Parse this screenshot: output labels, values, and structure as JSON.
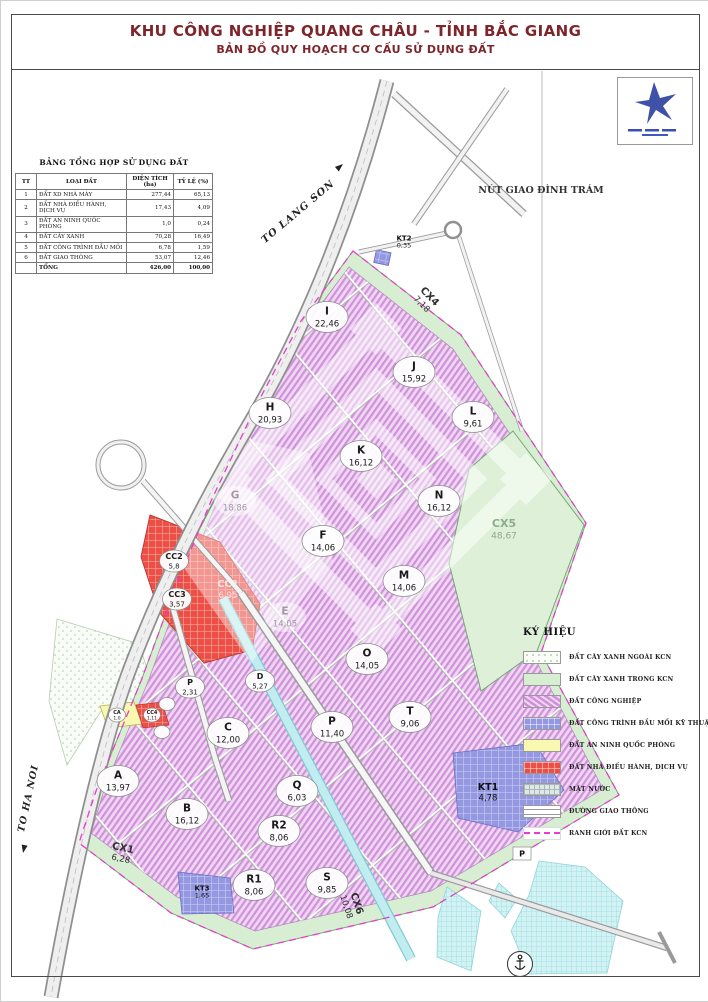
{
  "title": {
    "line1": "KHU CÔNG NGHIỆP QUANG CHÂU - TỈNH BẮC GIANG",
    "line2": "BẢN ĐỒ QUY HOẠCH CƠ CẤU SỬ DỤNG ĐẤT"
  },
  "summary_table": {
    "title": "BẢNG TỔNG HỢP SỬ DỤNG ĐẤT",
    "columns": [
      "TT",
      "LOẠI ĐẤT",
      "DIỆN TÍCH (ha)",
      "TỶ LỆ (%)"
    ],
    "rows": [
      [
        "1",
        "ĐẤT XD NHÀ MÁY",
        "277,44",
        "65,13"
      ],
      [
        "2",
        "ĐẤT NHÀ ĐIỀU HÀNH, DỊCH VỤ",
        "17,43",
        "4,09"
      ],
      [
        "3",
        "ĐẤT AN NINH QUỐC PHÒNG",
        "1,0",
        "0,24"
      ],
      [
        "4",
        "ĐẤT CÂY XANH",
        "70,28",
        "16,49"
      ],
      [
        "5",
        "ĐẤT CÔNG TRÌNH ĐẦU MỐI",
        "6,78",
        "1,59"
      ],
      [
        "6",
        "ĐẤT GIAO THÔNG",
        "53,07",
        "12,46"
      ]
    ],
    "total_row": [
      "",
      "TỔNG",
      "426,00",
      "100,00"
    ]
  },
  "legend": {
    "title": "KÝ HIỆU",
    "items": [
      {
        "label": "ĐẤT CÂY XANH NGOÀI KCN",
        "swatch": "green-outside"
      },
      {
        "label": "ĐẤT CÂY XANH TRONG KCN",
        "swatch": "green-inside"
      },
      {
        "label": "ĐẤT CÔNG NGHIỆP",
        "swatch": "industrial"
      },
      {
        "label": "ĐẤT CÔNG TRÌNH ĐẦU MỐI KỸ THUẬT",
        "swatch": "technical"
      },
      {
        "label": "ĐẤT AN NINH QUỐC PHÒNG",
        "swatch": "security"
      },
      {
        "label": "ĐẤT NHÀ ĐIỀU HÀNH, DỊCH VỤ",
        "swatch": "service"
      },
      {
        "label": "MẶT NƯỚC",
        "swatch": "water-surface"
      },
      {
        "label": "ĐƯỜNG GIAO THÔNG",
        "swatch": "road"
      },
      {
        "label": "RANH GIỚI ĐẤT KCN",
        "swatch": "boundary"
      }
    ]
  },
  "map": {
    "labels": {
      "to_lang_son": "TO LANG SON",
      "to_ha_noi": "TO HA NOI",
      "interchange": "NÚT GIAO ĐÌNH TRÁM"
    },
    "parcels": [
      {
        "id": "I",
        "area": "22,46",
        "x": 326,
        "y": 316,
        "kind": "circle"
      },
      {
        "id": "J",
        "area": "15,92",
        "x": 413,
        "y": 371,
        "kind": "circle"
      },
      {
        "id": "H",
        "area": "20,93",
        "x": 269,
        "y": 412,
        "kind": "circle"
      },
      {
        "id": "L",
        "area": "9,61",
        "x": 472,
        "y": 416,
        "kind": "circle"
      },
      {
        "id": "K",
        "area": "16,12",
        "x": 360,
        "y": 455,
        "kind": "circle"
      },
      {
        "id": "N",
        "area": "16,12",
        "x": 438,
        "y": 500,
        "kind": "circle"
      },
      {
        "id": "G",
        "area": "18,86",
        "x": 234,
        "y": 500,
        "kind": "ghost"
      },
      {
        "id": "CX5",
        "area": "48,67",
        "x": 503,
        "y": 528,
        "kind": "ghost-green"
      },
      {
        "id": "F",
        "area": "14,06",
        "x": 322,
        "y": 540,
        "kind": "circle"
      },
      {
        "id": "M",
        "area": "14,06",
        "x": 403,
        "y": 580,
        "kind": "circle"
      },
      {
        "id": "E",
        "area": "14,05",
        "x": 284,
        "y": 616,
        "kind": "ghost"
      },
      {
        "id": "CC2",
        "area": "5,8",
        "x": 173,
        "y": 560,
        "kind": "circle-sm"
      },
      {
        "id": "CC1",
        "area": "6,95",
        "x": 227,
        "y": 588,
        "kind": "ghost-red"
      },
      {
        "id": "CC3",
        "area": "3,57",
        "x": 176,
        "y": 598,
        "kind": "circle-sm"
      },
      {
        "id": "O",
        "area": "14,05",
        "x": 366,
        "y": 658,
        "kind": "circle"
      },
      {
        "id": "D",
        "area": "5,27",
        "x": 259,
        "y": 680,
        "kind": "circle-sm"
      },
      {
        "id": "P",
        "area": "2,31",
        "x": 189,
        "y": 686,
        "kind": "circle-sm"
      },
      {
        "id": "T",
        "area": "9,06",
        "x": 409,
        "y": 716,
        "kind": "circle"
      },
      {
        "id": "C",
        "area": "12,00",
        "x": 227,
        "y": 732,
        "kind": "circle"
      },
      {
        "id": "P",
        "area": "11,40",
        "x": 331,
        "y": 726,
        "kind": "circle"
      },
      {
        "id": "CA",
        "area": "1,0",
        "x": 116,
        "y": 714,
        "kind": "tiny"
      },
      {
        "id": "CC4",
        "area": "1,11",
        "x": 151,
        "y": 714,
        "kind": "tiny"
      },
      {
        "id": "A",
        "area": "13,97",
        "x": 117,
        "y": 780,
        "kind": "circle"
      },
      {
        "id": "Q",
        "area": "6,03",
        "x": 296,
        "y": 790,
        "kind": "circle"
      },
      {
        "id": "KT1",
        "area": "4,78",
        "x": 487,
        "y": 791,
        "kind": "plain"
      },
      {
        "id": "B",
        "area": "16,12",
        "x": 186,
        "y": 813,
        "kind": "circle"
      },
      {
        "id": "R2",
        "area": "8,06",
        "x": 278,
        "y": 830,
        "kind": "circle"
      },
      {
        "id": "CX1",
        "area": "6,28",
        "x": 121,
        "y": 852,
        "kind": "rot",
        "angle": 12
      },
      {
        "id": "R1",
        "area": "8,06",
        "x": 253,
        "y": 884,
        "kind": "circle"
      },
      {
        "id": "S",
        "area": "9,85",
        "x": 326,
        "y": 882,
        "kind": "circle"
      },
      {
        "id": "KT3",
        "area": "1,65",
        "x": 201,
        "y": 891,
        "kind": "plain-sm"
      },
      {
        "id": "CX6",
        "area": "10,08",
        "x": 351,
        "y": 904,
        "kind": "rot",
        "angle": 72
      },
      {
        "id": "KT2",
        "area": "0,35",
        "x": 403,
        "y": 241,
        "kind": "plain-sm"
      },
      {
        "id": "CX4",
        "area": "7,18",
        "x": 425,
        "y": 299,
        "kind": "rot",
        "angle": 46
      },
      {
        "id": "P",
        "area": "",
        "x": 521,
        "y": 853,
        "kind": "tag"
      },
      {
        "id": "",
        "area": "",
        "x": 166,
        "y": 703,
        "kind": "dot"
      },
      {
        "id": "",
        "area": "",
        "x": 161,
        "y": 731,
        "kind": "dot"
      }
    ]
  },
  "colors": {
    "title_text": "#7d252b",
    "industrial": "#cf92da",
    "green_in_kcn": "#d8eed2",
    "service_red": "#ec4f46",
    "technical_blue": "#9398e0",
    "security_yellow": "#f8f8b0",
    "water": "#c2edf0",
    "kcn_boundary": "#e83bd0"
  }
}
